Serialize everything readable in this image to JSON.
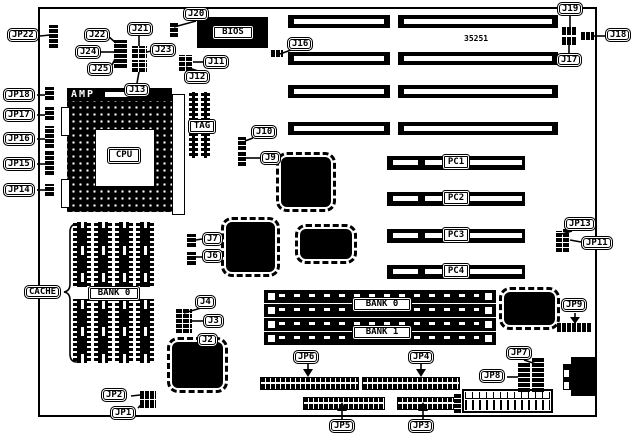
{
  "board": {
    "part_number": "35251"
  },
  "slots": {
    "pci": [
      "PC1",
      "PC2",
      "PC3",
      "PC4"
    ]
  },
  "chips": {
    "bios": "BIOS",
    "cpu": "CPU",
    "amp": "AMP",
    "tag": "TAG"
  },
  "banks": {
    "cache_bank0": "BANK 0",
    "simm_bank0": "BANK 0",
    "simm_bank1": "BANK 1"
  },
  "labels": {
    "jp22": "JP22",
    "j22": "J22",
    "j24": "J24",
    "j25": "J25",
    "j21": "J21",
    "j23": "J23",
    "j13": "J13",
    "j20": "J20",
    "j11": "J11",
    "j12": "J12",
    "j16": "J16",
    "j19": "J19",
    "j18": "J18",
    "j17": "J17",
    "jp18": "JP18",
    "jp17": "JP17",
    "jp16": "JP16",
    "jp15": "JP15",
    "jp14": "JP14",
    "j10": "J10",
    "j9": "J9",
    "jp13": "JP13",
    "jp11": "JP11",
    "j7": "J7",
    "j6": "J6",
    "cache": "CACHE",
    "j4": "J4",
    "j3": "J3",
    "j2": "J2",
    "jp9": "JP9",
    "jp7": "JP7",
    "jp8": "JP8",
    "jp6": "JP6",
    "jp4": "JP4",
    "jp5": "JP5",
    "jp3": "JP3",
    "jp2": "JP2",
    "jp1": "JP1"
  }
}
